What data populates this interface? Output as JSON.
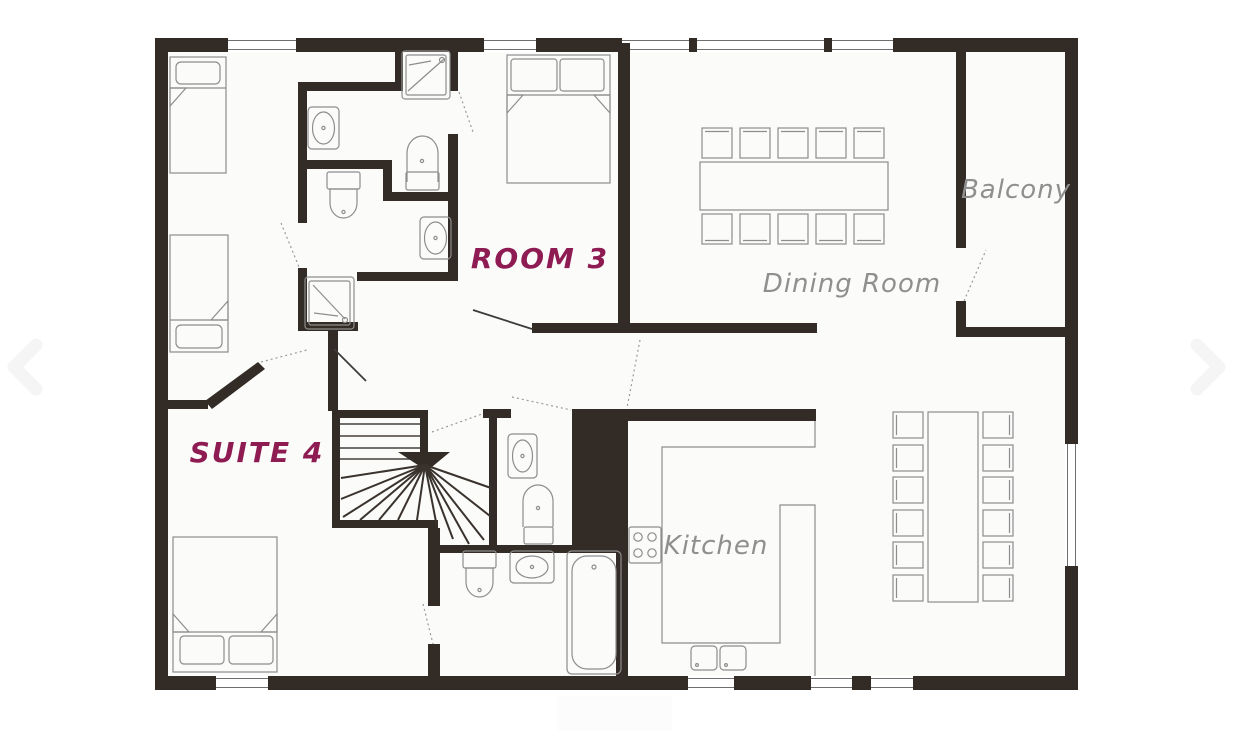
{
  "plan": {
    "labels": {
      "room3": "ROOM 3",
      "suite4": "SUITE 4",
      "dining": "Dining Room",
      "balcony": "Balcony",
      "kitchen": "Kitchen"
    },
    "colors": {
      "wall": "#332b25",
      "furniture": "#8d8d8d",
      "room_label": "#8e1c53",
      "area_label": "#8f8f8f",
      "floor": "#fbfbfa",
      "background": "#ffffff",
      "door_dash": "#9a9a9a",
      "door_leaf": "#3c3c3c"
    }
  },
  "viewer": {
    "prev_icon": "chevron-left",
    "next_icon": "chevron-right"
  }
}
